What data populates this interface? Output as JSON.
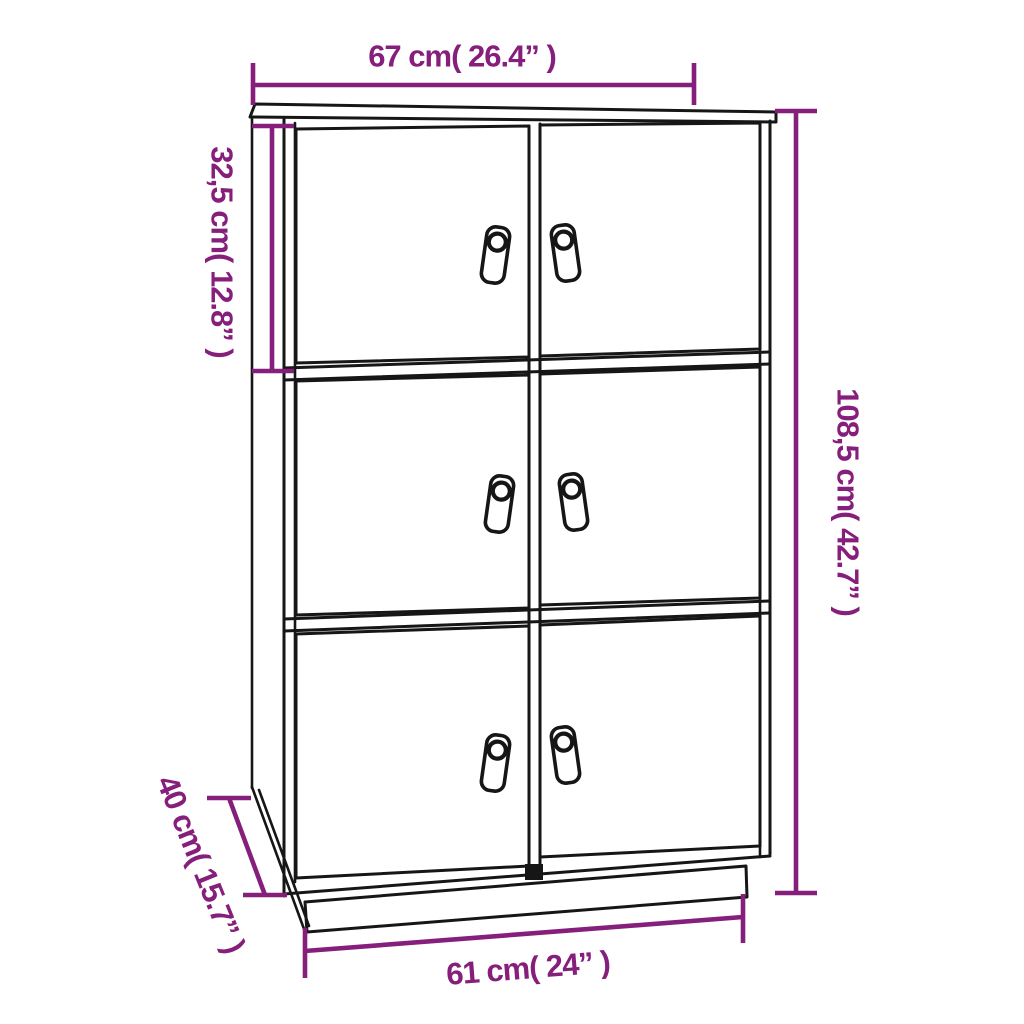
{
  "meta": {
    "background_color": "#ffffff",
    "line_color": "#161616",
    "dimension_color": "#861F7B"
  },
  "product": {
    "type": "highboard cabinet line drawing",
    "door_rows": 3,
    "door_columns": 2,
    "door_count": 6,
    "handle_style": "leather tag pull with ring hole",
    "base": "recessed plinth"
  },
  "dimensions": {
    "top_width": {
      "cm": "67",
      "inch": "26.4",
      "label": "67 cm(  26.4”  )"
    },
    "compartment_height": {
      "cm": "32,5",
      "inch": "12.8",
      "label": "32,5 cm( 12.8” )"
    },
    "total_height": {
      "cm": "108,5",
      "inch": "42.7",
      "label": "108,5 cm( 42.7” )"
    },
    "depth": {
      "cm": "40",
      "inch": "15.7",
      "label": "40 cm( 15.7” )"
    },
    "bottom_width": {
      "cm": "61",
      "inch": "24",
      "label": "61 cm( 24”  )"
    }
  }
}
